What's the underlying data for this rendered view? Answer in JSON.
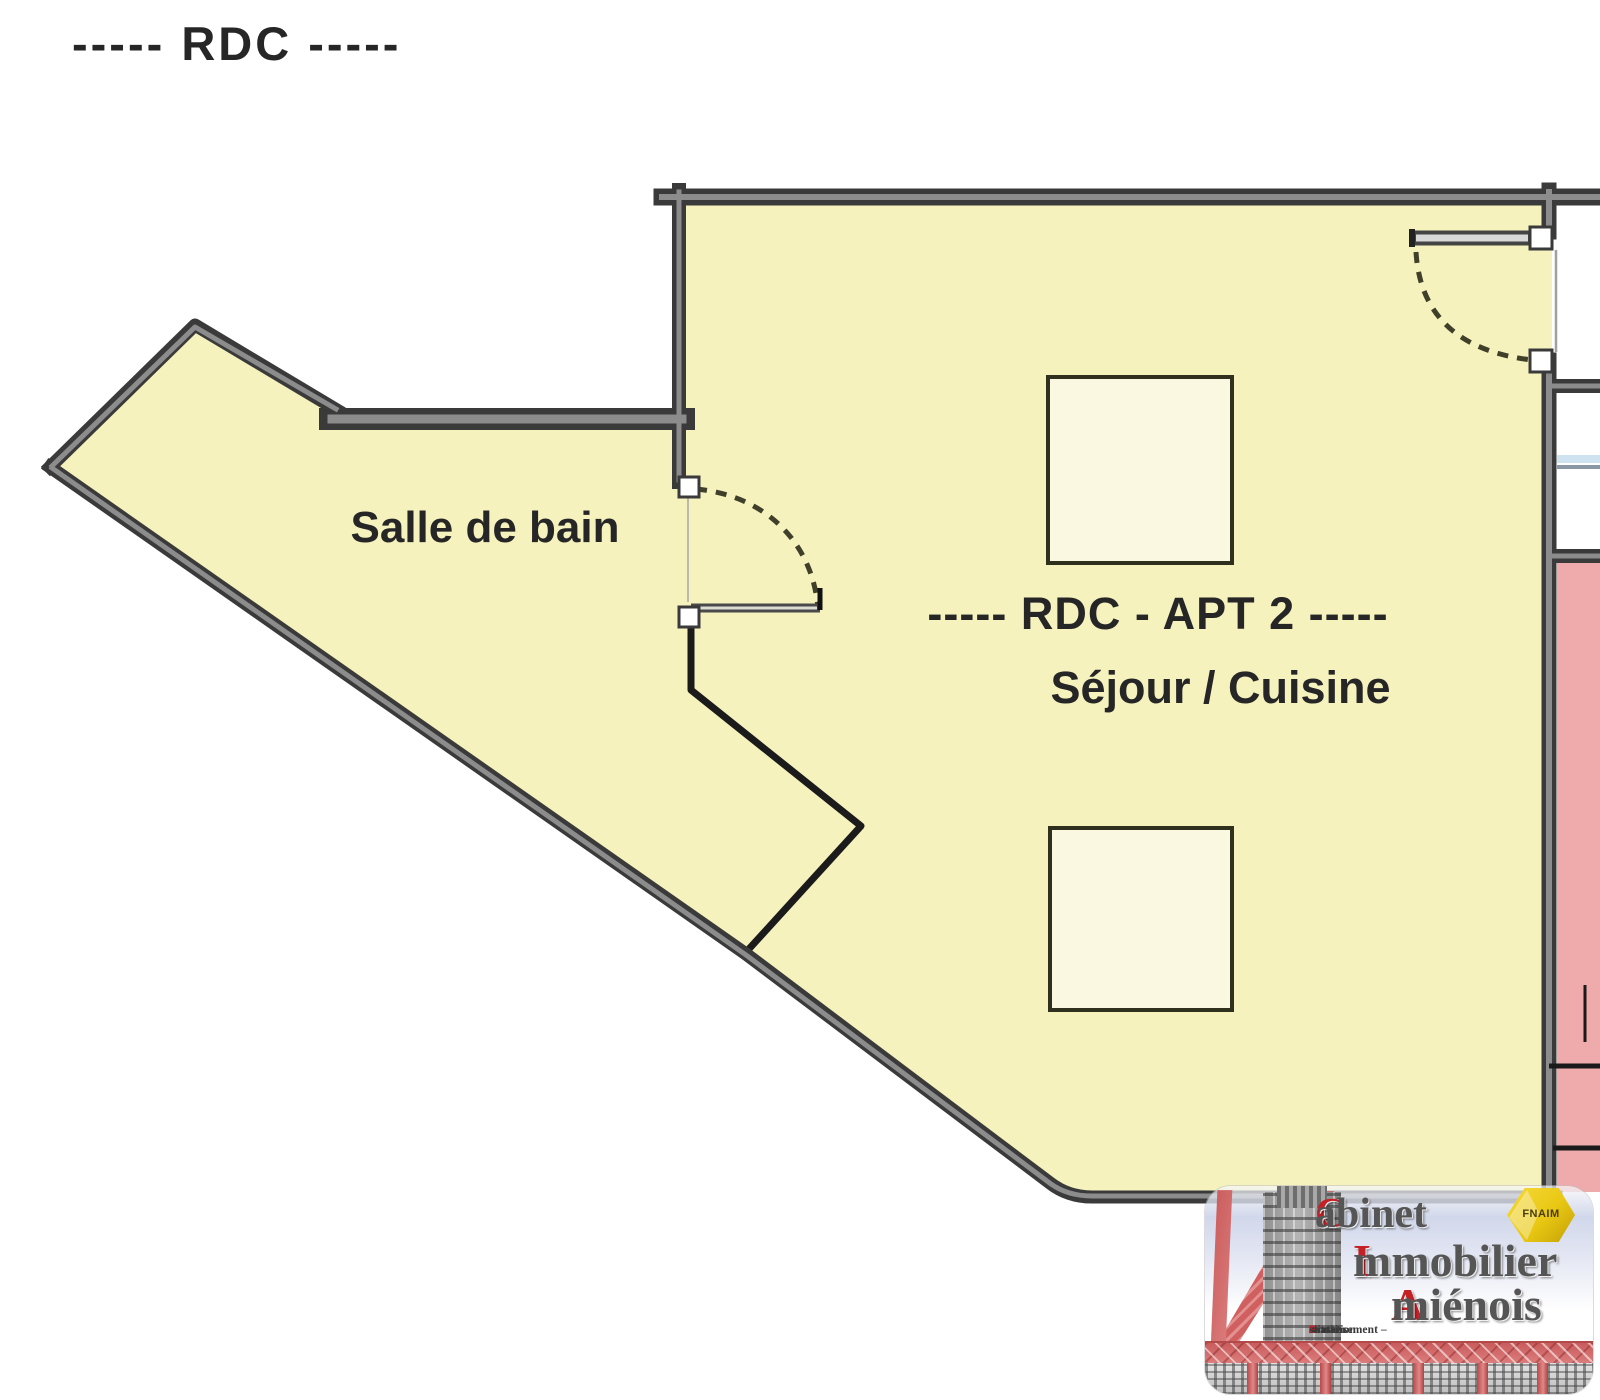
{
  "plan": {
    "floor_title": "-----  RDC  -----",
    "rooms": {
      "bathroom_label": "Salle de bain",
      "apartment_label": "-----  RDC - APT 2  -----",
      "living_label": "Séjour / Cuisine"
    }
  },
  "logo": {
    "brand": [
      {
        "initial": "C",
        "rest": "abinet"
      },
      {
        "initial": "I",
        "rest": "mmobilier"
      },
      {
        "initial": "A",
        "rest": "miénois"
      }
    ],
    "badge": "FNAIM",
    "tagline": [
      {
        "initial": "A",
        "rest": "chat – "
      },
      {
        "initial": "V",
        "rest": "ente – "
      },
      {
        "initial": "I",
        "rest": "nvestissement – "
      },
      {
        "initial": "L",
        "rest": "ocation - "
      },
      {
        "initial": "E",
        "rest": "stimation"
      }
    ]
  },
  "colors": {
    "roomYellow": "#f5f2bd",
    "squareFill": "#faf8e0",
    "wallDark": "#3a3a3a",
    "wallMid": "#8c8c8c",
    "pinkRoom": "#efabab",
    "brandRed": "#c42127",
    "badgeYellow": "#e9c713",
    "inkDark": "#262626"
  }
}
